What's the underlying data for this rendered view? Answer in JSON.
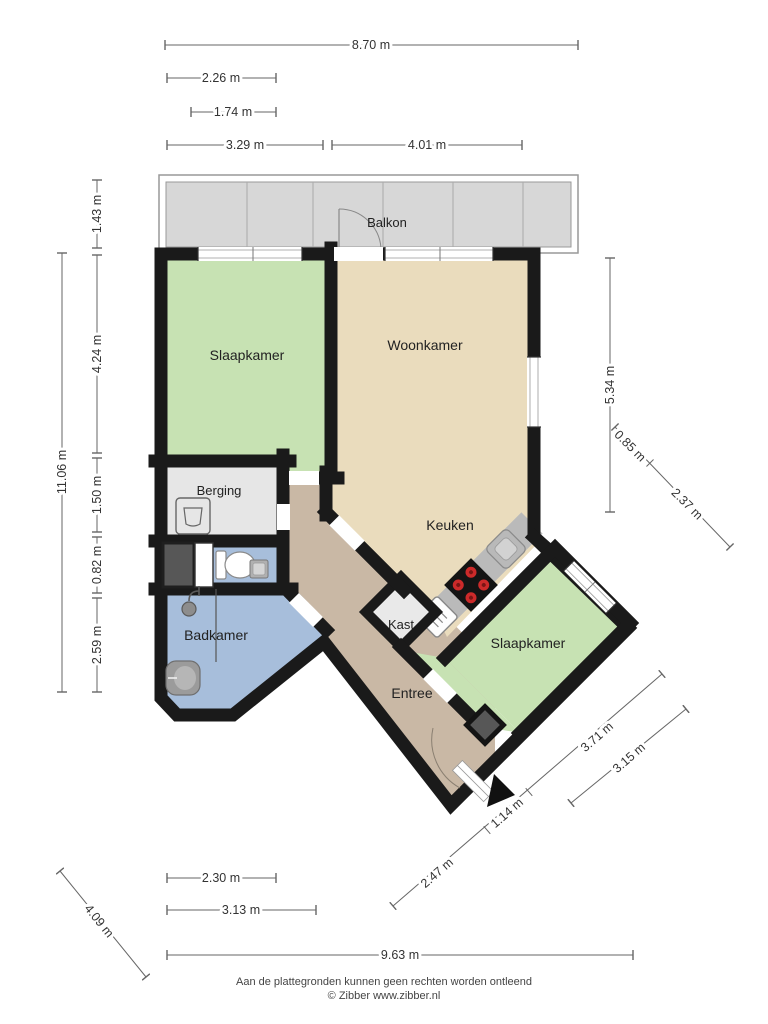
{
  "rooms": {
    "balcony": "Balkon",
    "bedroom1": "Slaapkamer",
    "living": "Woonkamer",
    "storage": "Berging",
    "kitchen": "Keuken",
    "closet": "Kast",
    "bathroom": "Badkamer",
    "bedroom2": "Slaapkamer",
    "hall": "Entree"
  },
  "dims": {
    "top_total": "8.70 m",
    "top_a": "2.26 m",
    "top_b": "1.74 m",
    "top_c": "3.29 m",
    "top_d": "4.01 m",
    "left_total": "11.06 m",
    "left_a": "1.43 m",
    "left_b": "4.24 m",
    "left_c": "1.50 m",
    "left_d": "0.82 m",
    "left_e": "2.59 m",
    "right_a": "5.34 m",
    "right_b": "0.85 m",
    "right_c": "2.37 m",
    "se_a": "2.47 m",
    "se_b": "1.14 m",
    "se_c": "3.71 m",
    "se_d": "3.15 m",
    "bottom_a": "2.30 m",
    "bottom_b": "3.13 m",
    "bottom_total": "9.63 m",
    "sw_diag": "4.09 m"
  },
  "footer": {
    "line1": "Aan de plattegronden kunnen geen rechten worden ontleend",
    "line2": "© Zibber www.zibber.nl"
  },
  "colors": {
    "wall": "#1a1a1a",
    "bedroom_green": "#c7e2b3",
    "living_beige": "#eadcbd",
    "bath_blue": "#a7bedb",
    "hall_tan": "#c9b8a5",
    "storage_grey": "#e6e6e6",
    "balcony_grey": "#d7d7d7",
    "counter_grey": "#c3c3c3",
    "burner_red": "#cc2a2a"
  }
}
